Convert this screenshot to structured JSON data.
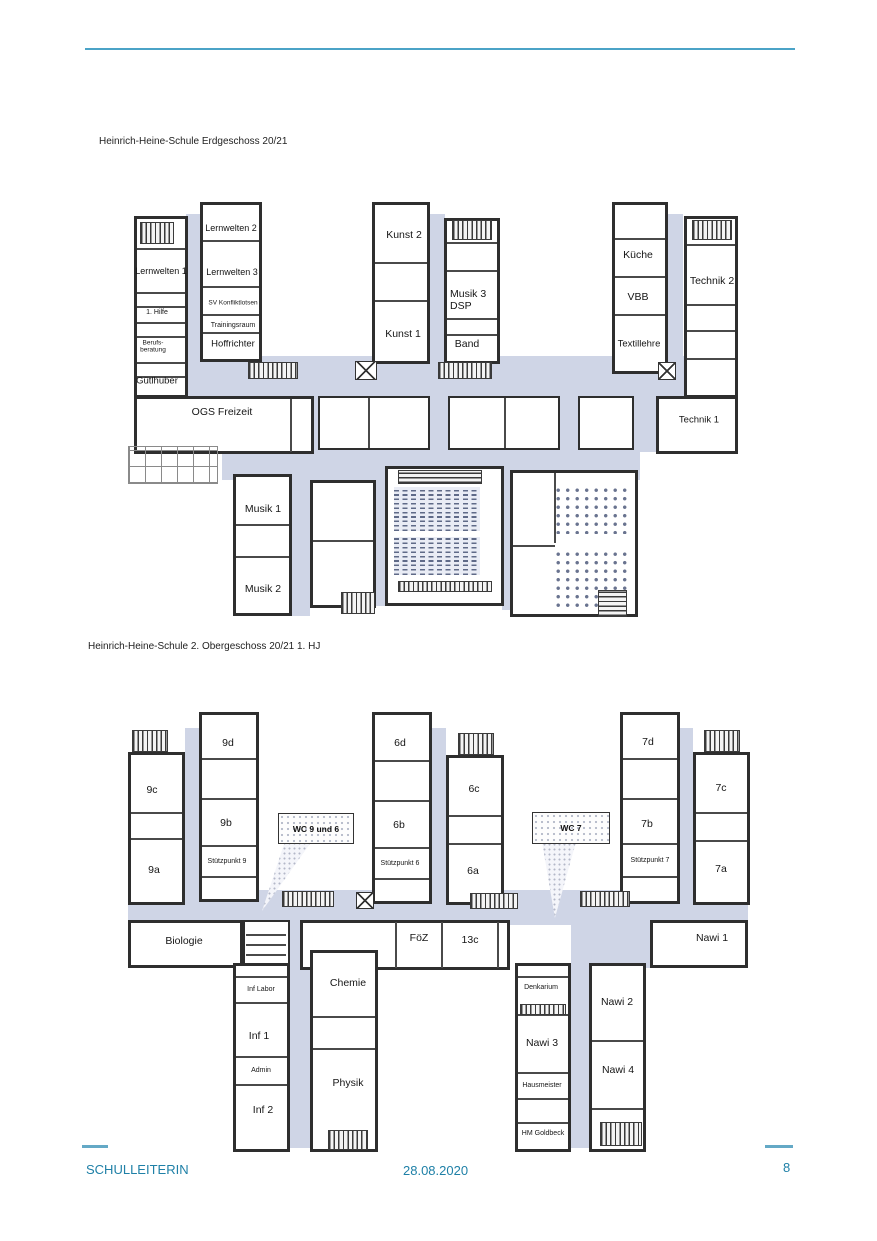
{
  "header": {
    "title_floor1": "Heinrich-Heine-Schule Erdgeschoss 20/21",
    "title_floor2": "Heinrich-Heine-Schule 2. Obergeschoss 20/21 1. HJ"
  },
  "footer": {
    "author": "SCHULLEITERIN",
    "date": "28.08.2020",
    "page_number": "8"
  },
  "colors": {
    "accent_line": "#4BA3C7",
    "footer_text": "#1F80A7",
    "corridor_fill": "#CFD5E6",
    "wall": "#2E2E2E"
  },
  "floor1": {
    "rooms": {
      "lernwelten1": "Lernwelten 1",
      "lernwelten2": "Lernwelten 2",
      "lernwelten3": "Lernwelten 3",
      "sv_konfliktlotsen": "SV Konfliktlotsen",
      "trainingsraum": "Trainingsraum",
      "hoffrichter": "Hoffrichter",
      "erste_hilfe": "1. Hilfe",
      "berufsberatung": "Berufs-beratung",
      "guetlhuber": "Gütlhuber",
      "ogs_freizeit": "OGS Freizeit",
      "kunst1": "Kunst 1",
      "kunst2": "Kunst 2",
      "musik3_dsp": "Musik 3 DSP",
      "band": "Band",
      "kueche": "Küche",
      "vbb": "VBB",
      "textillehre": "Textillehre",
      "technik1": "Technik 1",
      "technik2": "Technik 2",
      "musik1": "Musik 1",
      "musik2": "Musik 2"
    }
  },
  "floor2": {
    "rooms": {
      "9a": "9a",
      "9b": "9b",
      "9c": "9c",
      "9d": "9d",
      "stuetzpunkt9": "Stützpunkt 9",
      "6a": "6a",
      "6b": "6b",
      "6c": "6c",
      "6d": "6d",
      "stuetzpunkt6": "Stützpunkt 6",
      "7a": "7a",
      "7b": "7b",
      "7c": "7c",
      "7d": "7d",
      "stuetzpunkt7": "Stützpunkt 7",
      "wc_9_und_6": "WC 9 und 6",
      "wc_7": "WC 7",
      "biologie": "Biologie",
      "foez": "FöZ",
      "13c": "13c",
      "nawi1": "Nawi 1",
      "inf_labor": "Inf Labor",
      "inf1": "Inf 1",
      "admin": "Admin",
      "inf2": "Inf 2",
      "chemie": "Chemie",
      "physik": "Physik",
      "denkarium": "Denkarium",
      "nawi2": "Nawi 2",
      "nawi3": "Nawi 3",
      "nawi4": "Nawi 4",
      "hausmeister": "Hausmeister",
      "hm_goldbeck": "HM Goldbeck"
    }
  }
}
